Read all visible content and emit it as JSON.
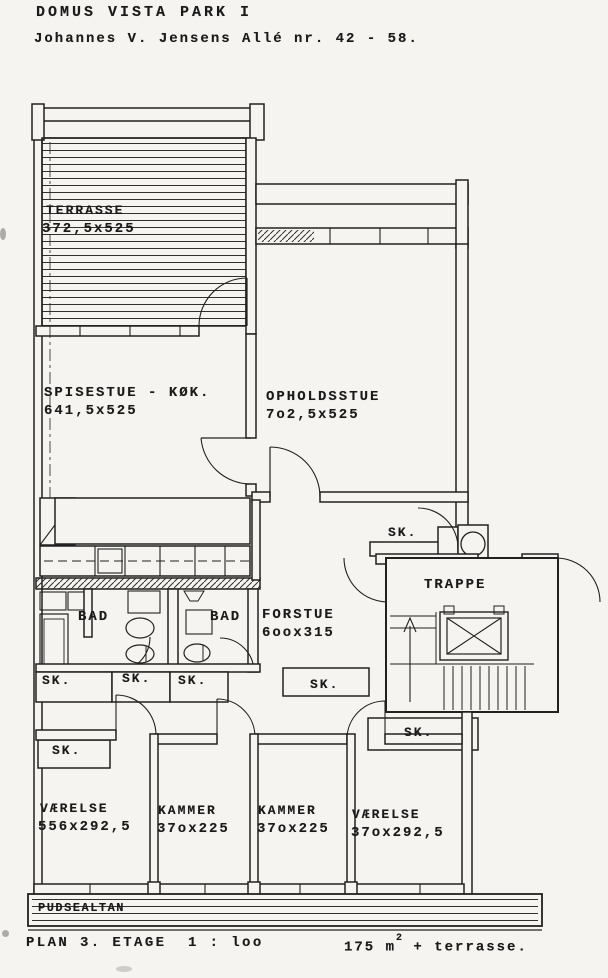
{
  "header": {
    "title": "DOMUS VISTA PARK I",
    "address": "Johannes V. Jensens Allé nr. 42 - 58."
  },
  "plan": {
    "rooms": {
      "terrasse": {
        "name": "TERRASSE",
        "dims": "372,5x525"
      },
      "spisestue": {
        "name": "SPISESTUE - KØK.",
        "dims": "641,5x525"
      },
      "opholdsstue": {
        "name": "OPHOLDSSTUE",
        "dims": "7o2,5x525"
      },
      "forstue": {
        "name": "FORSTUE",
        "dims": "6oox315"
      },
      "bad": {
        "name": "BAD"
      },
      "vaerelse_left": {
        "name": "VÆRELSE",
        "dims": "556x292,5"
      },
      "kammer": {
        "name": "KAMMER",
        "dims": "37ox225"
      },
      "vaerelse_right": {
        "name": "VÆRELSE",
        "dims": "37ox292,5"
      }
    },
    "labels": {
      "sk": "SK.",
      "trappe": "TRAPPE",
      "pudsealtan": "PUDSEALTAN"
    }
  },
  "footer": {
    "plan_label": "PLAN 3. ETAGE  1 : loo",
    "area_value": "175 m",
    "area_exponent": "2",
    "area_suffix": " + terrasse."
  },
  "colors": {
    "paper": "#f5f4f0",
    "ink": "#1d1d1d"
  }
}
